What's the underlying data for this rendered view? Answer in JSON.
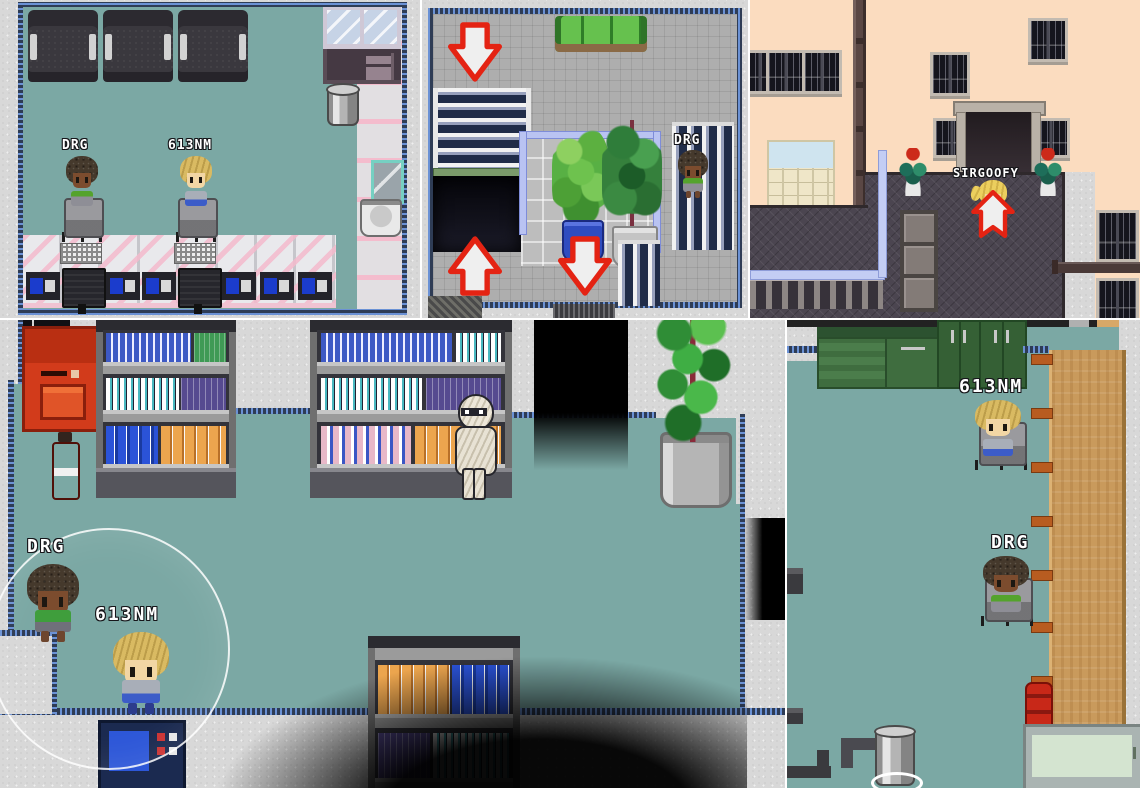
{
  "scene": {
    "kind": "pixel-rpg-screenshot-collage",
    "panel_count": 5
  },
  "colors": {
    "floor_teal": "#7BA8A4",
    "tile_gray": "#AEAEAE",
    "wall_peach": "#FBDCBF",
    "platform_dark": "#4B4550",
    "arrow_red": "#E42313",
    "vending_red": "#D23B1B",
    "cabinet_green": "#3F6D3F",
    "table_wood": "#C99A5C",
    "label_text": "#FFFFFF"
  },
  "panels": [
    {
      "id": "computer-room",
      "objects": [
        "dark-sofas",
        "glass-cabinet",
        "desk",
        "trash-can",
        "mirror",
        "sink",
        "desk-row",
        "keyboards",
        "monitors",
        "control-panels",
        "office-chairs"
      ],
      "characters": [
        {
          "label": "DRG",
          "pose": "seated"
        },
        {
          "label": "613NM",
          "pose": "seated"
        }
      ]
    },
    {
      "id": "stair-hall",
      "objects": [
        "green-couch",
        "staircase-down",
        "escalator",
        "potted-plants",
        "railings",
        "exit-arrows"
      ],
      "characters": [
        {
          "label": "DRG",
          "pose": "standing"
        }
      ]
    },
    {
      "id": "building-exterior",
      "objects": [
        "windows",
        "entrance-doorway",
        "drain-pipe",
        "folding-doors",
        "crates",
        "flower-planters",
        "walkway",
        "exit-arrow"
      ],
      "characters": [
        {
          "label": "SIRGOOFY",
          "pose": "standing"
        }
      ]
    },
    {
      "id": "dark-store",
      "objects": [
        "vending-machine",
        "fire-extinguisher",
        "bookshelves",
        "doorway",
        "potted-plant",
        "mummy",
        "light-circle",
        "computer-console"
      ],
      "characters": [
        {
          "label": "DRG",
          "pose": "standing"
        },
        {
          "label": "613NM",
          "pose": "standing"
        }
      ]
    },
    {
      "id": "kitchen-office",
      "objects": [
        "green-cabinets",
        "wooden-table",
        "office-chairs",
        "trash-can",
        "fire-hydrant",
        "counter-appliance"
      ],
      "characters": [
        {
          "label": "613NM",
          "pose": "seated"
        },
        {
          "label": "DRG",
          "pose": "seated"
        }
      ]
    }
  ]
}
